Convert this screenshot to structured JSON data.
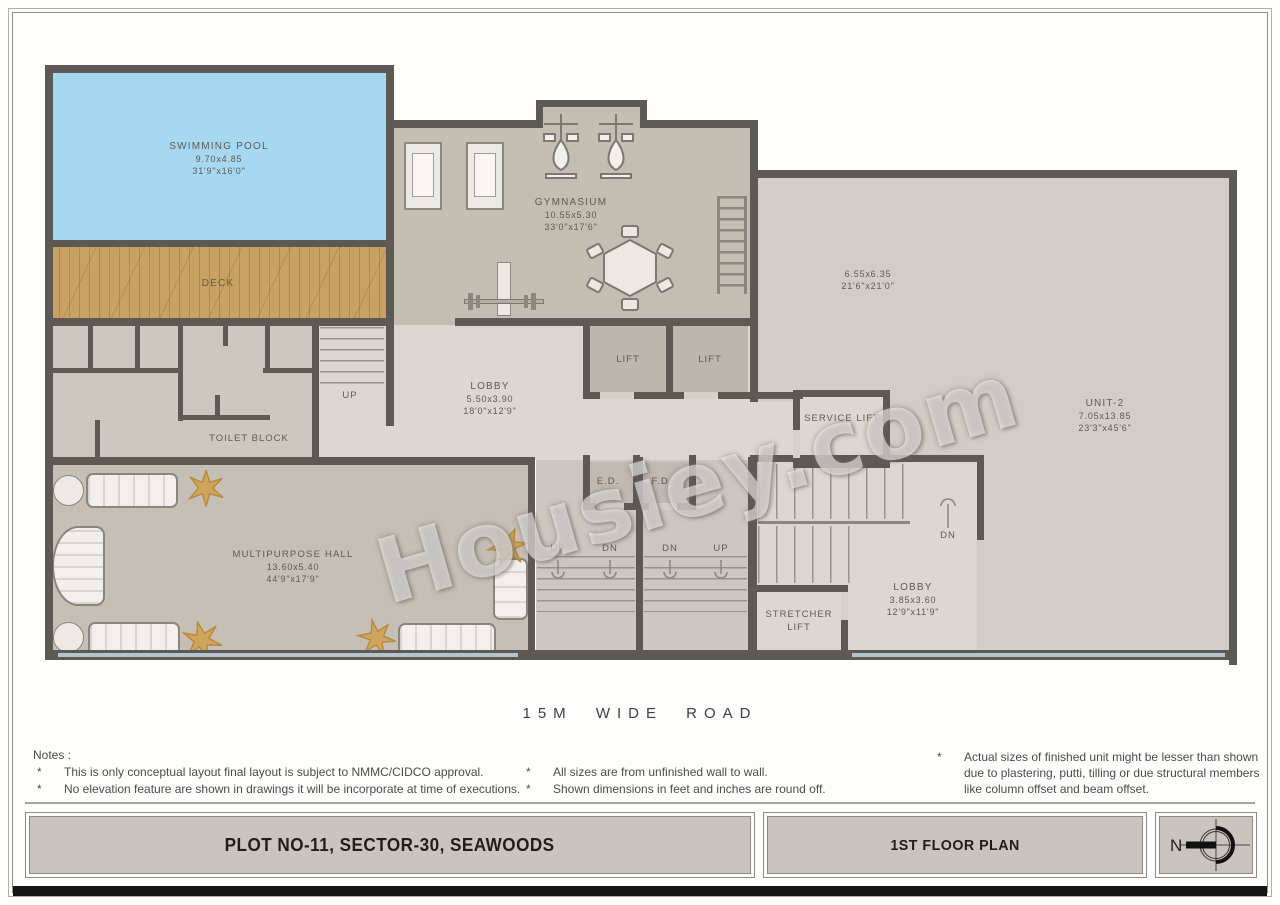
{
  "watermark": {
    "text": "Housiey.com"
  },
  "road": {
    "label": "15M WIDE ROAD"
  },
  "compass": {
    "north": "N"
  },
  "titles": {
    "plot": "PLOT NO-11, SECTOR-30, SEAWOODS",
    "plan": "1ST  FLOOR PLAN"
  },
  "notes": {
    "heading": "Notes :",
    "bullet": "*",
    "col1": [
      "This is only conceptual layout final layout is subject to NMMC/CIDCO approval.",
      "No elevation feature are shown in drawings it will be incorporate at time of executions."
    ],
    "col2": [
      "All sizes are from unfinished wall to wall.",
      "Shown dimensions in feet and inches are round off."
    ],
    "col3": [
      "Actual sizes of finished unit might be lesser than shown",
      "due to plastering, putti, tilling  or due structural members",
      "like column offset and beam offset."
    ]
  },
  "rooms": {
    "swimming_pool": {
      "name": "SWIMMING POOL",
      "dim_m": "9.70x4.85",
      "dim_ft": "31'9\"x16'0\""
    },
    "deck": {
      "name": "DECK"
    },
    "gymnasium": {
      "name": "GYMNASIUM",
      "dim_m": "10.55x5.30",
      "dim_ft": "33'0\"x17'6\""
    },
    "open_area": {
      "dim_m": "6.55x6.35",
      "dim_ft": "21'6\"x21'0\""
    },
    "unit2": {
      "name": "UNIT-2",
      "dim_m": "7.05x13.85",
      "dim_ft": "23'3\"x45'6\""
    },
    "lobby_main": {
      "name": "LOBBY",
      "dim_m": "5.50x3.90",
      "dim_ft": "18'0\"x12'9\""
    },
    "lobby_unit": {
      "name": "LOBBY",
      "dim_m": "3.85x3.60",
      "dim_ft": "12'9\"x11'9\""
    },
    "lift": {
      "name": "LIFT"
    },
    "service_lift": {
      "name": "SERVICE LIFT"
    },
    "stretcher_lift": {
      "name": "STRETCHER LIFT"
    },
    "toilet_block": {
      "name": "TOILET BLOCK"
    },
    "multipurpose_hall": {
      "name": "MULTIPURPOSE HALL",
      "dim_m": "13.60x5.40",
      "dim_ft": "44'9\"x17'9\""
    },
    "shaft_ed": {
      "label": "E.D."
    },
    "shaft_fd": {
      "label": "F.D."
    }
  },
  "stairs": {
    "up": "UP",
    "dn": "DN"
  },
  "colors": {
    "wall": "#5d5955",
    "pool": "#a6d9f1",
    "deck": "#c9a163",
    "floor_gym": "#c4bdb2",
    "floor_unit": "#d2cdc6",
    "floor_light": "#dcd8d1",
    "floor_hall": "#c6bfb5",
    "floor_toilet": "#cdc7bf",
    "floor_lift": "#bcb6ad",
    "floor_stair": "#ccc7c0",
    "title_fill": "#cac4be",
    "glass": "#b8c4cd",
    "gold": "#c89b4e",
    "text": "#5f5a54"
  }
}
